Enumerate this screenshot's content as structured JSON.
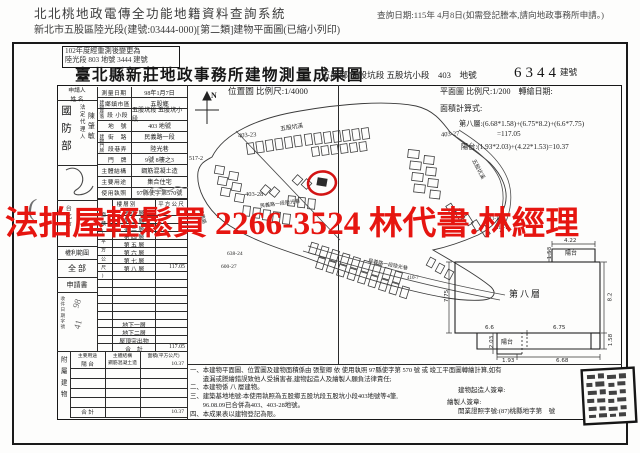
{
  "header": {
    "system_title": "北北桃地政電傳全功能地籍資料查詢系統",
    "query_date": "查詢日期:115年 4月8日(如需登記謄本,請向地政事務所申請。)",
    "subtitle": "新北市五股區陸光段(建號:03444-000)[第二類]建物平面圖(已縮小列印)"
  },
  "watermark": {
    "text": "法拍屋輕鬆買 2266-3524 林代書.林經理",
    "color": "#e61510"
  },
  "doc": {
    "remark_line1": "102年度經重測後變更為",
    "remark_line2": "陸光段 803 地號 3444 建號",
    "title": "臺北縣新莊地政事務所建物測量成果圖",
    "land_ref": "五股鄉 五股坑段 五股坑小段　403　地號",
    "building_no": "6344",
    "building_no_label": "建號"
  },
  "applicant": {
    "header_line1": "申請人",
    "header_line2": "姓 名",
    "name": "國防部",
    "agent_label": "法定代理人",
    "agent_name": "陳肇敏",
    "address": "台北市",
    "rights_label": "權利範圍",
    "rights_value": "全 部",
    "application_label": "申請書",
    "receipt_label": "收件日期字號",
    "receipt_num1": "98",
    "receipt_num2": "41",
    "margin_mark": "("
  },
  "survey": {
    "situs_label": "建物座落",
    "door_label": "建物門牌",
    "rows": [
      {
        "label": "測量日期",
        "value": "98年1月7日"
      },
      {
        "label": "鄉鎮市區",
        "value": "五股鄉"
      },
      {
        "label": "段 小段",
        "value": "五股坑段 五股坑小段"
      },
      {
        "label": "地　號",
        "value": "403 地號"
      },
      {
        "label": "街　路",
        "value": "民義路一段"
      },
      {
        "label": "段巷弄",
        "value": "陸光巷"
      },
      {
        "label": "門　牌",
        "value": "9號 8樓之3"
      },
      {
        "label": "主體結構",
        "value": "鋼筋混凝土造"
      },
      {
        "label": "主要用途",
        "value": "集合住宅"
      },
      {
        "label": "使用執照",
        "value": "97縣使字第570號"
      }
    ]
  },
  "floors": {
    "col_label": "面積(平方公尺)",
    "header_left": "樓 層 別",
    "header_right": "平 方 公 尺",
    "rows": [
      {
        "label": "地 面 層",
        "value": ""
      },
      {
        "label": "第 二 層",
        "value": ""
      },
      {
        "label": "第 三 層",
        "value": ""
      },
      {
        "label": "第 四 層",
        "value": ""
      },
      {
        "label": "第 五 層",
        "value": ""
      },
      {
        "label": "第 六 層",
        "value": ""
      },
      {
        "label": "第 七 層",
        "value": ""
      },
      {
        "label": "第 八 層",
        "value": "117.05"
      },
      {
        "label": "",
        "value": ""
      },
      {
        "label": "",
        "value": ""
      },
      {
        "label": "",
        "value": ""
      },
      {
        "label": "",
        "value": ""
      },
      {
        "label": "",
        "value": ""
      },
      {
        "label": "",
        "value": ""
      },
      {
        "label": "地下一層",
        "value": ""
      },
      {
        "label": "地下二層",
        "value": ""
      },
      {
        "label": "屋頂突出物",
        "value": ""
      },
      {
        "label": "合　計",
        "value": "117.05"
      }
    ]
  },
  "annex": {
    "col_label": "附屬建物",
    "header": [
      "主要用途",
      "主體結構",
      "面積(平方公尺)"
    ],
    "rows": [
      {
        "use": "陽 台",
        "structure": "鋼筋混凝土造",
        "area": "10.37"
      },
      {
        "use": "",
        "structure": "",
        "area": ""
      },
      {
        "use": "",
        "structure": "",
        "area": ""
      },
      {
        "use": "",
        "structure": "",
        "area": ""
      },
      {
        "use": "",
        "structure": "",
        "area": ""
      },
      {
        "use": "合 計",
        "structure": "",
        "area": "10.37"
      }
    ]
  },
  "site_map": {
    "title": "位置圖 比例尺:1/4000",
    "north": "N",
    "labels": [
      {
        "text": "517-2",
        "x": 189,
        "y": 156,
        "s": 6,
        "r": 0
      },
      {
        "text": "403-23",
        "x": 238,
        "y": 132,
        "s": 6.5,
        "r": -4
      },
      {
        "text": "五股坑溪",
        "x": 280,
        "y": 122,
        "s": 5.8,
        "r": -8
      },
      {
        "text": "403-27",
        "x": 441,
        "y": 131,
        "s": 6.5,
        "r": -4
      },
      {
        "text": "403-28",
        "x": 245,
        "y": 191,
        "s": 6.5,
        "r": 0
      },
      {
        "text": "民義路一段陸光巷",
        "x": 260,
        "y": 200,
        "s": 5,
        "r": -7
      },
      {
        "text": "五股坑溪",
        "x": 468,
        "y": 165,
        "s": 5.4,
        "r": 62
      },
      {
        "text": "民義路",
        "x": 195,
        "y": 213,
        "s": 5,
        "r": 75
      },
      {
        "text": "638-24",
        "x": 227,
        "y": 251,
        "s": 5.5,
        "r": 0
      },
      {
        "text": "600-27",
        "x": 221,
        "y": 264,
        "s": 5.5,
        "r": 0
      },
      {
        "text": "411-19",
        "x": 487,
        "y": 217,
        "s": 5,
        "r": 0
      },
      {
        "text": "411-11",
        "x": 496,
        "y": 226,
        "s": 5,
        "r": 0
      },
      {
        "text": "民義路一段陸光巷",
        "x": 368,
        "y": 261,
        "s": 5,
        "r": 11
      },
      {
        "text": "410-7",
        "x": 407,
        "y": 276,
        "s": 5,
        "r": 0
      }
    ]
  },
  "floor_plan": {
    "scale_line": "平面圖 比例尺:1/200　轉繪日期:",
    "calc_label": "面積計算式:",
    "calc_line1": "第八層:(6.68*1.58)+(6.75*8.2)+(6.6*7.75)",
    "calc_line2": "=117.05",
    "calc_line3": "陽台:(1.93*2.03)+(4.22*1.53)=10.37",
    "room_label": "第八層",
    "balcony_top_label": "陽台",
    "balcony_bottom_label": "陽台",
    "dims": [
      {
        "text": "4.22",
        "x": 564,
        "y": 238,
        "r": 0
      },
      {
        "text": "1.53",
        "x": 544,
        "y": 250,
        "r": -90
      },
      {
        "text": "7.75",
        "x": 441,
        "y": 293,
        "r": -90
      },
      {
        "text": "8.2",
        "x": 606,
        "y": 294,
        "r": -90
      },
      {
        "text": "6.6",
        "x": 485,
        "y": 325,
        "r": 0
      },
      {
        "text": "6.75",
        "x": 553,
        "y": 325,
        "r": 0
      },
      {
        "text": "2.03",
        "x": 486,
        "y": 339,
        "r": -90
      },
      {
        "text": "1.58",
        "x": 605,
        "y": 337,
        "r": -90
      },
      {
        "text": "1.93",
        "x": 502,
        "y": 358,
        "r": 0
      },
      {
        "text": "6.68",
        "x": 556,
        "y": 358,
        "r": 0
      }
    ]
  },
  "notes": {
    "lines": [
      "一、本建物平面圖、位置圖及建物面積係由 張聖卿 依 使用執照 97縣使字第 570 號 或 竣工平面圖轉繪計算,如有",
      "　　遺漏或謄繪錯誤致他人受損害者,建物起造人及繪製人願負法律責任;",
      "二、本建物係 八 層建物。",
      "三、建築基地地號:本使用執照為五股鄉五股坑段五股坑小段403地號等4筆,",
      "　　96.08.09已合併為403、403-28地號。",
      "四、本成果表以建物登記為限。"
    ],
    "builder_sign": "建物起造人簽章:",
    "drafter_sign": "繪製人簽章:",
    "license": "開業證照字號:(87)桃縣地字第　號"
  }
}
